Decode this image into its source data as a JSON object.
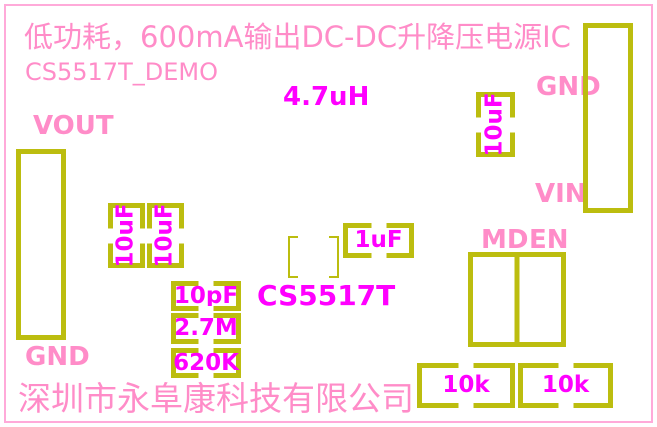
{
  "board": {
    "title": "低功耗，600mA输出DC-DC升降压电源IC",
    "subtitle": "CS5517T_DEMO",
    "company": "深圳市永阜康科技有限公司",
    "chip_name": "CS5517T",
    "inductor_value": "4.7uH"
  },
  "labels": {
    "vout": "VOUT",
    "gnd_left": "GND",
    "gnd_right": "GND",
    "vin": "VIN",
    "md": "MD",
    "en": "EN"
  },
  "components": {
    "output_cap_1": "10uF",
    "output_cap_2": "10uF",
    "input_cap": "10uF",
    "bypass_cap": "1uF",
    "feedback_cap": "10pF",
    "feedback_res_upper": "2.7M",
    "feedback_res_lower": "620K",
    "pulldown_res_md": "10k",
    "pulldown_res_en": "10k"
  },
  "colors": {
    "silkscreen_olive": "#bcbd0f",
    "label_pink": "#ff8cc8",
    "value_magenta": "#ff00ff",
    "page_border_pink": "#ffaad9",
    "background": "#ffffff"
  }
}
